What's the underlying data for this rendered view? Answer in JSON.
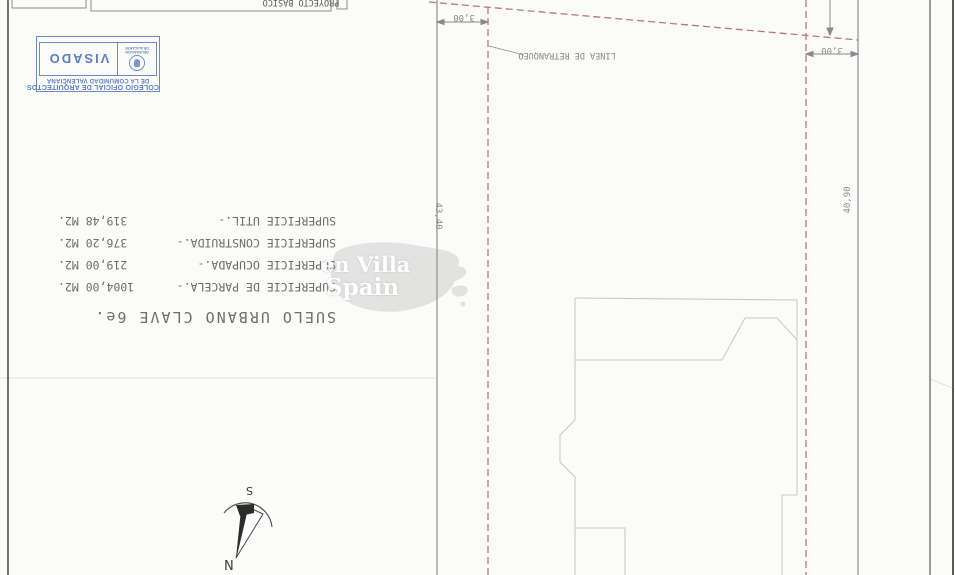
{
  "title_block": {
    "label": "PROYECTO BASICO"
  },
  "stamp": {
    "org_line1": "COLEGIO OFICIAL DE ARQUITECTOS",
    "org_line2": "DE LA COMUNIDAD VALENCIANA",
    "delegation_line1": "DELEGACION",
    "delegation_line2": "DE ALICANTE",
    "visado": "VISADO",
    "color": "#5b7fc0"
  },
  "zoning": {
    "title": "SUELO URBANO CLAVE 6e.",
    "surfaces": [
      {
        "label": "SUPERFICIE DE PARCELA.-",
        "value": "1004,00 M2."
      },
      {
        "label": "SUPERFICIE OCUPADA.-",
        "value": "219,00 M2."
      },
      {
        "label": "SUPERFICIE CONSTRUIDA.-",
        "value": "376,20 M2."
      },
      {
        "label": "SUPERFICIE UTIL.-",
        "value": "319,48 M2."
      }
    ]
  },
  "plan": {
    "setback_label": "LINEA DE RETRANQUEO",
    "dim_front_left": "3,00",
    "dim_front_right": "3,00",
    "dim_side_left": "43,40",
    "dim_side_right": "40,90",
    "boundary_color": "#a8606c"
  },
  "compass": {
    "south": "S",
    "north": "N"
  },
  "watermark": {
    "line1": "en Villa",
    "line2": "Spain"
  }
}
